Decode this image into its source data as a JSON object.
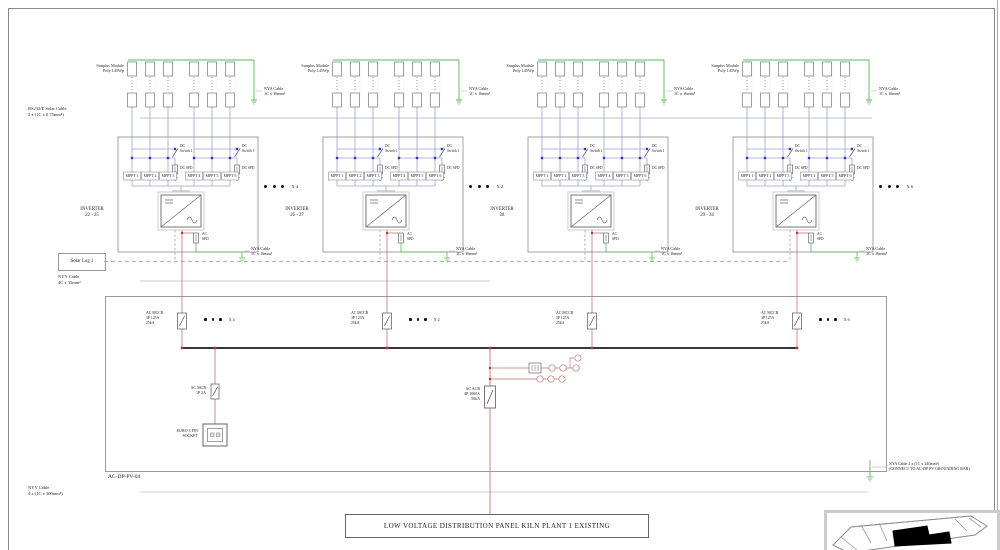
{
  "sheet": {
    "rs232_label": [
      "RS232/E Solar Cable",
      "2 x (1C x 0.75mm²)"
    ],
    "solar_log": "Solar Log 1",
    "ac_cable_label": [
      "NYY Cable",
      "4C x 35mm²"
    ],
    "panel_id": "AC-DP-PV-04",
    "main_cable_label": [
      "NYY Cable",
      "4 x (1C x 300mm²)"
    ],
    "grounding_cable_label": [
      "NYA Cable 2 x (1C x 240mm²)",
      "(CONNECT TO AC-DP PV GROUNDING BAR)"
    ],
    "acb_label": [
      "AC ACB",
      "4P 1000A",
      "50kA"
    ],
    "mcb_label": [
      "AC MCB",
      "1P 2A"
    ],
    "socket_label": [
      "EURO 3 PIN",
      "SOCKET"
    ],
    "lv_panel_label": "LOW VOLTAGE DISTRIBUTION PANEL KILN PLANT 1 EXISTING"
  },
  "groups": [
    {
      "module_label": [
        "Sunplus Module",
        "Poly 145Wp"
      ],
      "string_ground_cable": [
        "NYA Cable",
        "1C x 16mm²"
      ],
      "dc_switch": [
        "DC",
        "Switch 1"
      ],
      "dc_spd": "DC SPD",
      "mppt": [
        "MPPT 1",
        "MPPT 2",
        "MPPT 3",
        "MPPT 4",
        "MPPT 5",
        "MPPT 6"
      ],
      "inverter_title": "INVERTER",
      "inverter_range": "22 - 25",
      "multiplier": "X 4",
      "ac_spd": [
        "AC",
        "SPD"
      ],
      "mccb_label": [
        "AC MCCB",
        "3P 125A",
        "25kA"
      ],
      "ac_ground_cable": [
        "NYA Cable",
        "1C x 16mm²"
      ]
    },
    {
      "module_label": [
        "Sunplus Module",
        "Poly 145Wp"
      ],
      "string_ground_cable": [
        "NYA Cable",
        "1C x 16mm²"
      ],
      "dc_switch": [
        "DC",
        "Switch 1"
      ],
      "dc_spd": "DC SPD",
      "mppt": [
        "MPPT 1",
        "MPPT 2",
        "MPPT 3",
        "MPPT 4",
        "MPPT 5",
        "MPPT 6"
      ],
      "inverter_title": "INVERTER",
      "inverter_range": "26 - 27",
      "multiplier": "X 2",
      "ac_spd": [
        "AC",
        "SPD"
      ],
      "mccb_label": [
        "AC MCCB",
        "3P 125A",
        "25kA"
      ],
      "ac_ground_cable": [
        "NYA Cable",
        "1C x 16mm²"
      ]
    },
    {
      "module_label": [
        "Sunplus Module",
        "Poly 145Wp"
      ],
      "string_ground_cable": [
        "NYA Cable",
        "1C x 16mm²"
      ],
      "dc_switch": [
        "DC",
        "Switch 1"
      ],
      "dc_spd": "DC SPD",
      "mppt": [
        "MPPT 1",
        "MPPT 2",
        "MPPT 3",
        "MPPT 4",
        "MPPT 5",
        "MPPT 6"
      ],
      "inverter_title": "INVERTER",
      "inverter_range": "28",
      "multiplier": "",
      "ac_spd": [
        "AC",
        "SPD"
      ],
      "mccb_label": [
        "AC MCCB",
        "3P 125A",
        "25kA"
      ],
      "ac_ground_cable": [
        "NYA Cable",
        "1C x 16mm²"
      ]
    },
    {
      "module_label": [
        "Sunplus Module",
        "Poly 145Wp"
      ],
      "string_ground_cable": [
        "NYA Cable",
        "1C x 16mm²"
      ],
      "dc_switch": [
        "DC",
        "Switch 1"
      ],
      "dc_spd": "DC SPD",
      "mppt": [
        "MPPT 1",
        "MPPT 2",
        "MPPT 3",
        "MPPT 4",
        "MPPT 5",
        "MPPT 6"
      ],
      "inverter_title": "INVERTER",
      "inverter_range": "29 - 34",
      "multiplier": "X 6",
      "ac_spd": [
        "AC",
        "SPD"
      ],
      "mccb_label": [
        "AC MCCB",
        "3P 125A",
        "25kA"
      ],
      "ac_ground_cable": [
        "NYA Cable",
        "1C x 16mm²"
      ]
    }
  ],
  "colors": {
    "pv_dc_line": "#9aa2cc",
    "grounding": "#55bb55",
    "ac_line": "#cc7070",
    "main_bus": "#1a1a1a",
    "structure": "#999999"
  }
}
